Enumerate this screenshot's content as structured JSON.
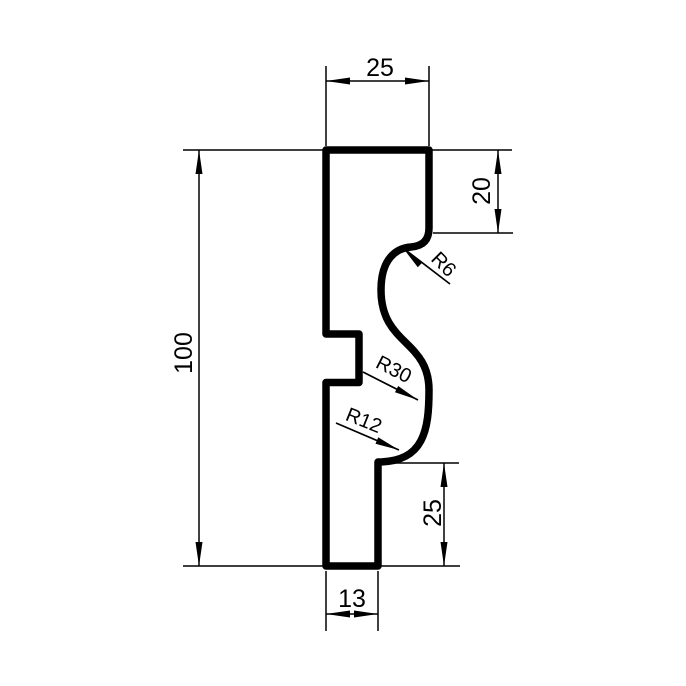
{
  "drawing": {
    "description": "technical cross-section drawing of a moulding profile with dimensions",
    "units_implied": "mm",
    "dimensions": {
      "top_width": "25",
      "upper_right_height": "20",
      "overall_height": "100",
      "lower_right_height": "25",
      "bottom_width": "13"
    },
    "radii": {
      "upper": "R6",
      "middle": "R30",
      "lower": "R12"
    },
    "colors": {
      "line": "#000000",
      "background": "#ffffff"
    }
  }
}
